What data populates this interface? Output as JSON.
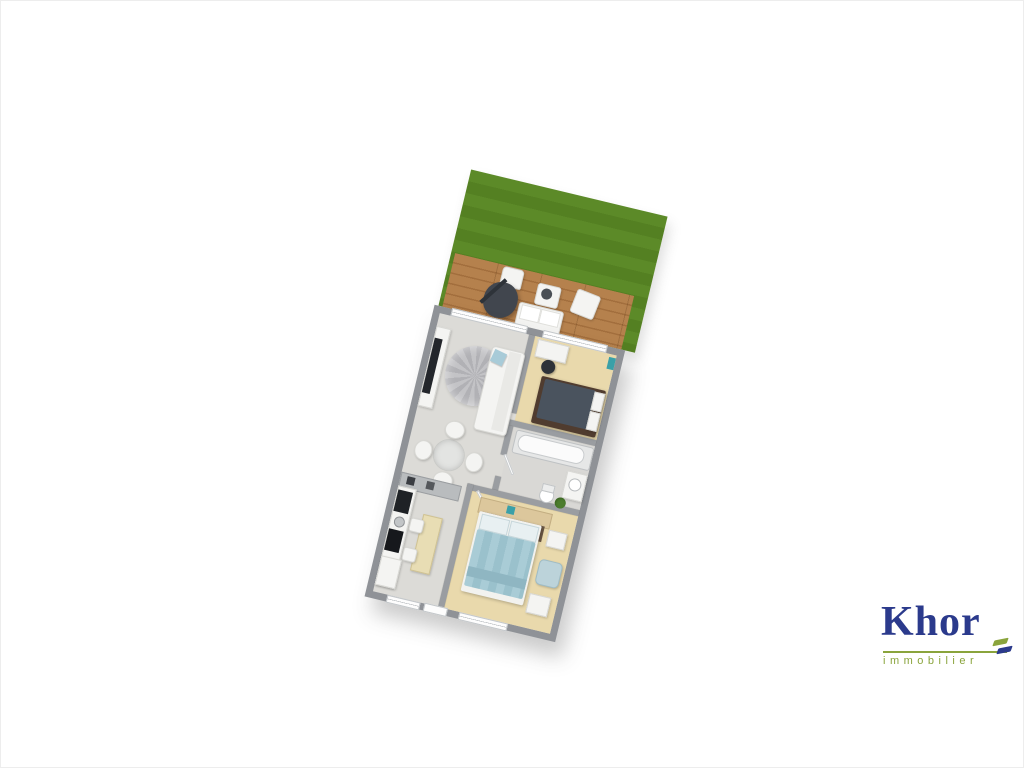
{
  "brand": {
    "name": "Khor",
    "tagline": "immobilier",
    "name_color": "#2b3a8c",
    "tagline_color": "#8aa43c",
    "underline_color": "#8aa43c"
  },
  "floorplan": {
    "view": "3d-top-down-render",
    "rotation_deg": 13.5,
    "colors": {
      "grass": "#5c8a28",
      "deck_wood": "#b5814d",
      "exterior_wall": "#8f9297",
      "interior_wall": "#9a9da1",
      "floor_main": "#dcdbd7",
      "floor_bedroom": "#e9d9ac",
      "floor_bathroom": "#d9d8d5",
      "bed_blue": "#a9ccd6",
      "bed_dark_duvet": "#4a535e",
      "bed_dark_frame": "#503c2f"
    },
    "garden": {
      "type": "lawn",
      "terrace": {
        "material": "wood-deck",
        "furniture": [
          "armchair",
          "lounge-chair-with-parasol",
          "coffee-table",
          "ottoman",
          "loveseat"
        ]
      }
    },
    "rooms": [
      {
        "name": "living-room",
        "floor": "light-gray",
        "furniture": [
          "tv-sideboard",
          "tv",
          "round-rug",
          "sofa",
          "blue-cushion"
        ]
      },
      {
        "name": "dining-area",
        "floor": "light-gray",
        "furniture": [
          "round-glass-table",
          "chair",
          "chair",
          "chair",
          "chair"
        ]
      },
      {
        "name": "kitchen",
        "floor": "light-gray",
        "furniture": [
          "peninsula-counter",
          "oven",
          "cooktop",
          "sink",
          "fridge",
          "breakfast-table",
          "stool",
          "stool"
        ]
      },
      {
        "name": "bedroom-1",
        "floor": "beige",
        "furniture": [
          "desk",
          "desk-chair",
          "double-bed-dark",
          "wall-shelf-teal"
        ]
      },
      {
        "name": "bathroom",
        "floor": "light-gray",
        "furniture": [
          "bathtub",
          "washbasin-vanity",
          "toilet",
          "plant"
        ]
      },
      {
        "name": "bedroom-2",
        "floor": "beige",
        "furniture": [
          "headboard-shelf",
          "double-bed-blue",
          "dark-rug",
          "nightstand",
          "armchair",
          "side-table"
        ]
      }
    ],
    "openings": [
      "terrace-bay-window-living",
      "terrace-bay-window-bedroom-1",
      "kitchen-window",
      "bedroom-2-window",
      "entry-door",
      "bedroom-1-door",
      "bathroom-door",
      "bedroom-2-door"
    ]
  }
}
